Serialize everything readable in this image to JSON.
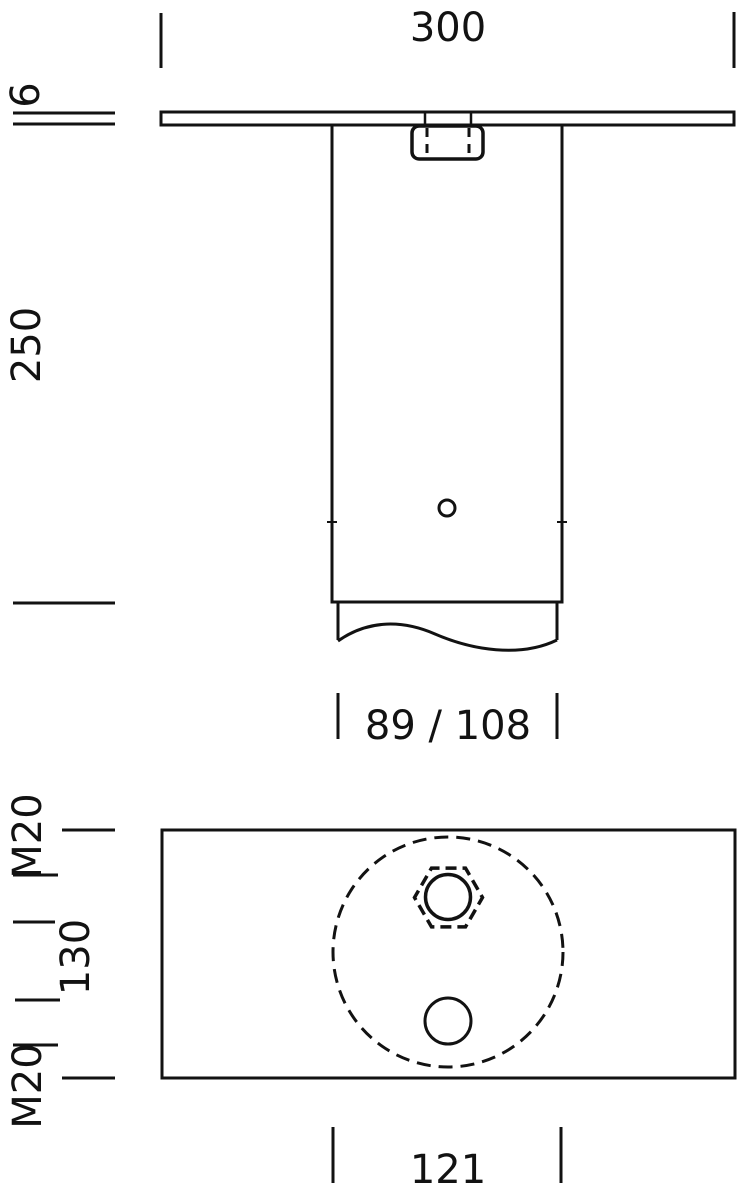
{
  "colors": {
    "line": "#121212",
    "background": "#ffffff"
  },
  "front_view": {
    "plate_width": "300",
    "plate_thickness": "6",
    "post_height": "250",
    "tube_diameters": "89 / 108"
  },
  "plan_view": {
    "thread_top": "M20",
    "hole_spacing": "130",
    "thread_bottom": "M20",
    "circle_diameter": "121"
  }
}
